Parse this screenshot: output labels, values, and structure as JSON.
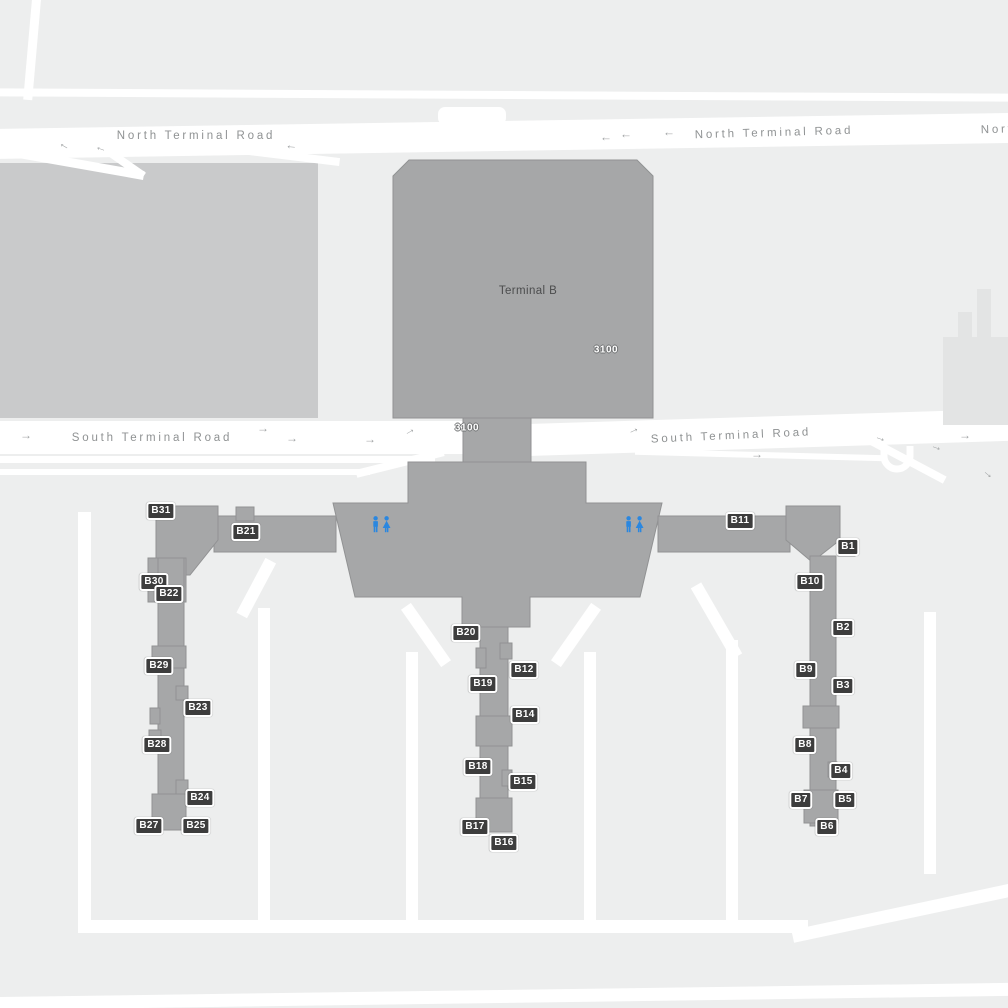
{
  "map": {
    "title": "Terminal B airport map",
    "colors": {
      "bg": "#edeeee",
      "road": "#ffffff",
      "building": "#a6a7a8",
      "building-edge": "#919293",
      "parking": "#c9cacb",
      "faint": "#e3e4e4",
      "badge-bg": "#3d3d3d",
      "badge-text": "#ffffff",
      "road-text": "#8f9293",
      "terminal-text": "#4b4c4d",
      "restroom": "#2a87e0"
    }
  },
  "terminal": {
    "name": "Terminal B",
    "label_x": 528,
    "label_y": 291,
    "building_numbers": [
      {
        "text": "3100",
        "x": 606,
        "y": 350
      },
      {
        "text": "3100",
        "x": 467,
        "y": 428
      }
    ]
  },
  "road_labels": [
    {
      "text": "North Terminal Road",
      "x": 196,
      "y": 136,
      "rot": 0
    },
    {
      "text": "North Terminal Road",
      "x": 774,
      "y": 133,
      "rot": -1.6
    },
    {
      "text": "North Terminal Road",
      "x": 1060,
      "y": 128,
      "rot": -1.6
    },
    {
      "text": "South Terminal Road",
      "x": 152,
      "y": 438,
      "rot": 0
    },
    {
      "text": "South Terminal Road",
      "x": 731,
      "y": 436,
      "rot": -2.6
    }
  ],
  "gates": [
    {
      "label": "B31",
      "x": 161,
      "y": 511
    },
    {
      "label": "B21",
      "x": 246,
      "y": 532
    },
    {
      "label": "B30",
      "x": 154,
      "y": 582
    },
    {
      "label": "B22",
      "x": 169,
      "y": 594
    },
    {
      "label": "B29",
      "x": 159,
      "y": 666
    },
    {
      "label": "B23",
      "x": 198,
      "y": 708
    },
    {
      "label": "B28",
      "x": 157,
      "y": 745
    },
    {
      "label": "B24",
      "x": 200,
      "y": 798
    },
    {
      "label": "B27",
      "x": 149,
      "y": 826
    },
    {
      "label": "B25",
      "x": 196,
      "y": 826
    },
    {
      "label": "B20",
      "x": 466,
      "y": 633
    },
    {
      "label": "B12",
      "x": 524,
      "y": 670
    },
    {
      "label": "B19",
      "x": 483,
      "y": 684
    },
    {
      "label": "B14",
      "x": 525,
      "y": 715
    },
    {
      "label": "B18",
      "x": 478,
      "y": 767
    },
    {
      "label": "B15",
      "x": 523,
      "y": 782
    },
    {
      "label": "B17",
      "x": 475,
      "y": 827
    },
    {
      "label": "B16",
      "x": 504,
      "y": 843
    },
    {
      "label": "B11",
      "x": 740,
      "y": 521
    },
    {
      "label": "B1",
      "x": 848,
      "y": 547
    },
    {
      "label": "B10",
      "x": 810,
      "y": 582
    },
    {
      "label": "B2",
      "x": 843,
      "y": 628
    },
    {
      "label": "B9",
      "x": 806,
      "y": 670
    },
    {
      "label": "B3",
      "x": 843,
      "y": 686
    },
    {
      "label": "B8",
      "x": 805,
      "y": 745
    },
    {
      "label": "B4",
      "x": 841,
      "y": 771
    },
    {
      "label": "B7",
      "x": 801,
      "y": 800
    },
    {
      "label": "B5",
      "x": 845,
      "y": 800
    },
    {
      "label": "B6",
      "x": 827,
      "y": 827
    }
  ],
  "amenities": [
    {
      "type": "restroom",
      "x": 371,
      "y": 516
    },
    {
      "type": "restroom",
      "x": 624,
      "y": 516
    }
  ],
  "arrows": [
    {
      "x": 63,
      "y": 148,
      "rot": 210
    },
    {
      "x": 100,
      "y": 151,
      "rot": 200
    },
    {
      "x": 291,
      "y": 149,
      "rot": 185
    },
    {
      "x": 606,
      "y": 141,
      "rot": 180
    },
    {
      "x": 626,
      "y": 138,
      "rot": 180
    },
    {
      "x": 669,
      "y": 136,
      "rot": 180
    },
    {
      "x": 26,
      "y": 435,
      "rot": 0
    },
    {
      "x": 263,
      "y": 428,
      "rot": 0
    },
    {
      "x": 292,
      "y": 438,
      "rot": 0
    },
    {
      "x": 370,
      "y": 439,
      "rot": 0
    },
    {
      "x": 409,
      "y": 430,
      "rot": -30
    },
    {
      "x": 633,
      "y": 429,
      "rot": -25
    },
    {
      "x": 757,
      "y": 454,
      "rot": 0
    },
    {
      "x": 881,
      "y": 437,
      "rot": 20
    },
    {
      "x": 937,
      "y": 446,
      "rot": 20
    },
    {
      "x": 965,
      "y": 435,
      "rot": 0
    },
    {
      "x": 989,
      "y": 473,
      "rot": 40
    }
  ]
}
